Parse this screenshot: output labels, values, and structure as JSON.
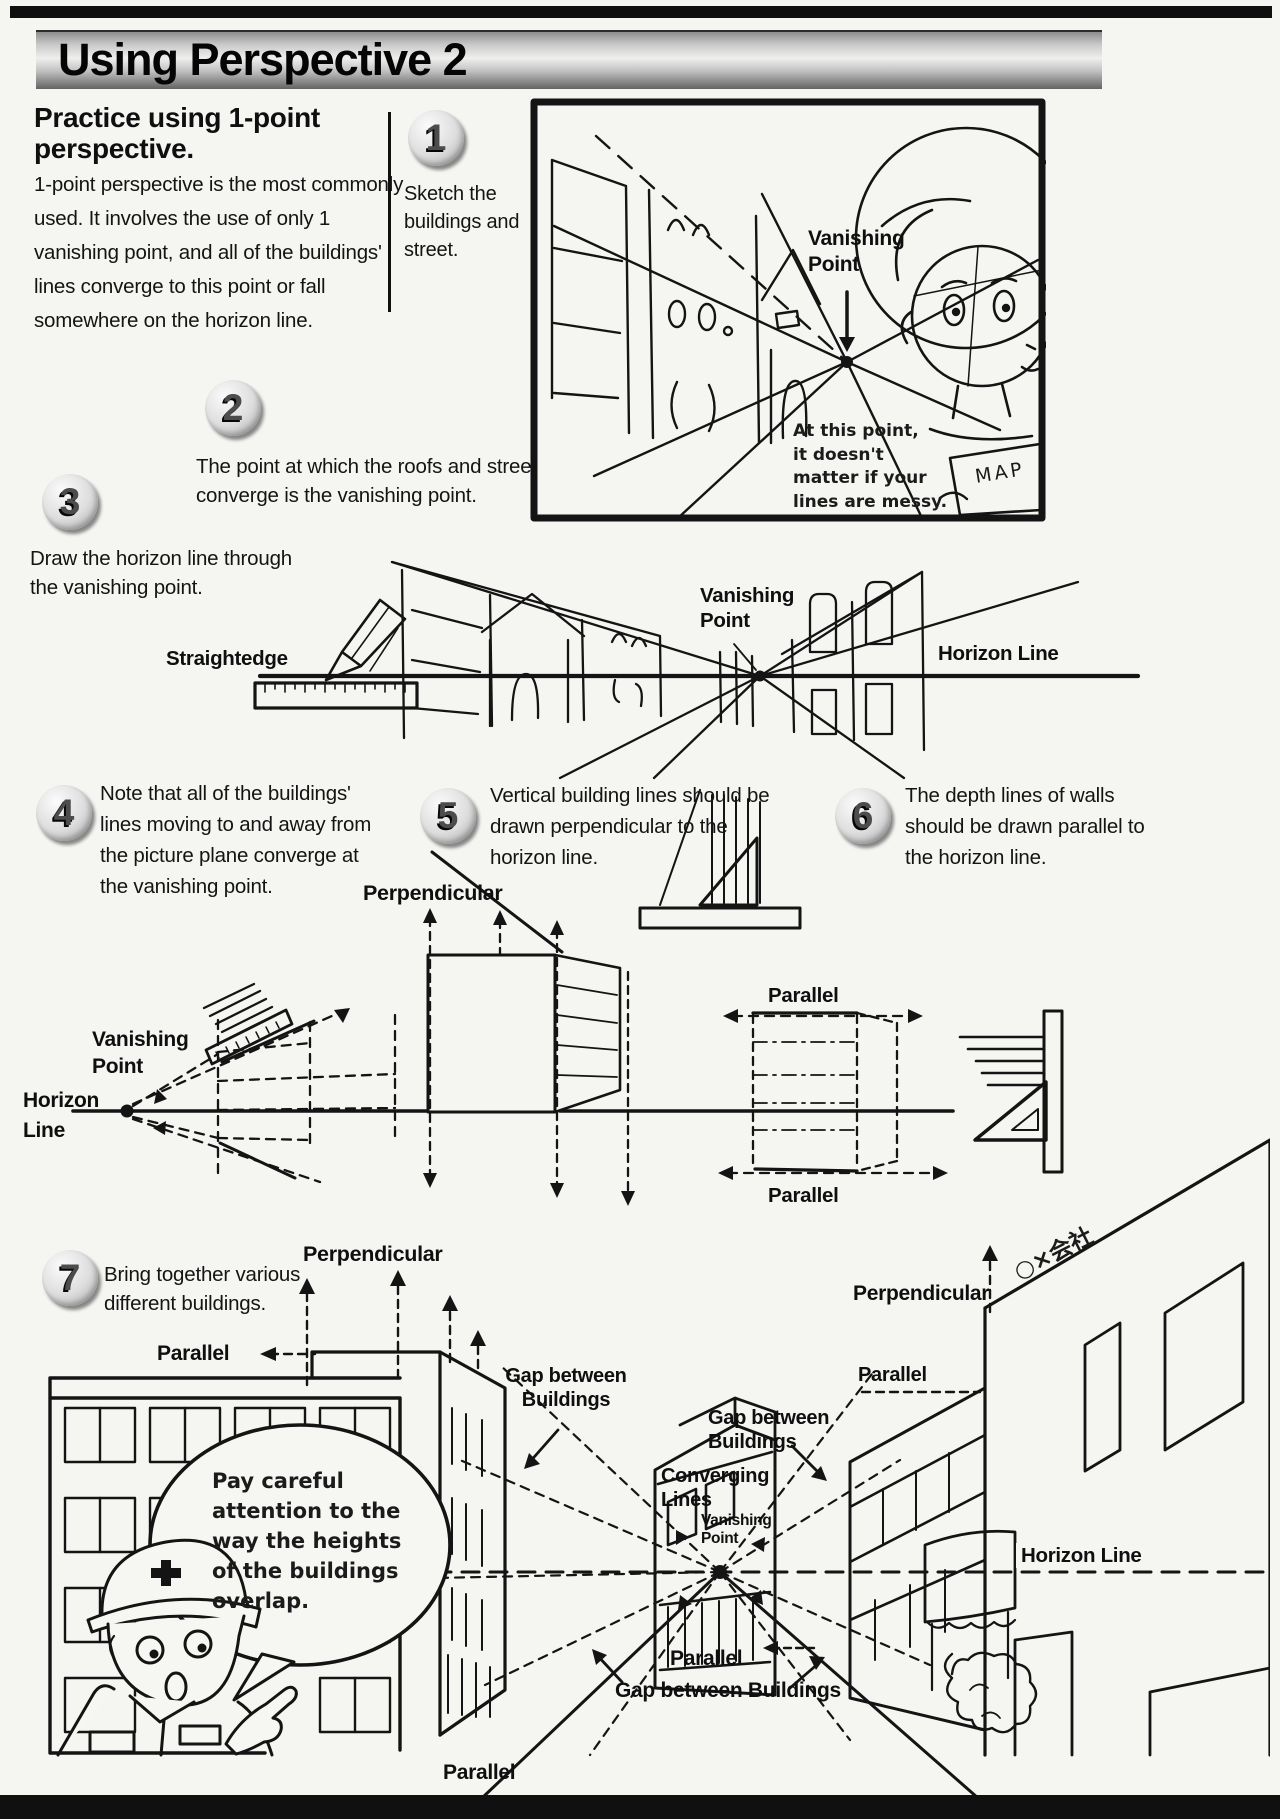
{
  "page": {
    "title": "Using Perspective 2"
  },
  "intro": {
    "heading": "Practice using 1-point\nperspective.",
    "body": "1-point perspective is the most commonly\nused. It involves the use of only 1\nvanishing point, and all of the buildings'\nlines converge to this point or fall\nsomewhere on the horizon line."
  },
  "steps": [
    {
      "num": "1",
      "text": "Sketch the\nbuildings and\nstreet."
    },
    {
      "num": "2",
      "text": "The point at which the roofs and street\nconverge is the vanishing point."
    },
    {
      "num": "3",
      "text": "Draw the horizon line through\nthe vanishing point."
    },
    {
      "num": "4",
      "text": "Note that all of the buildings'\nlines moving to and away from\nthe picture plane converge at\nthe vanishing point."
    },
    {
      "num": "5",
      "text": "Vertical building lines should be\ndrawn perpendicular to the\nhorizon line."
    },
    {
      "num": "6",
      "text": "The depth lines of walls\nshould be drawn parallel to\nthe horizon line."
    },
    {
      "num": "7",
      "text": "Bring together various\ndifferent buildings."
    }
  ],
  "panel1": {
    "vanishing_point": "Vanishing\nPoint",
    "note": "At this point,\nit doesn't\nmatter if your\nlines are messy.",
    "map": "MAP"
  },
  "diagram3": {
    "straightedge": "Straightedge",
    "vanishing_point": "Vanishing\nPoint",
    "horizon_line": "Horizon Line"
  },
  "diagram456": {
    "perpendicular": "Perpendicular",
    "vanishing_point": "Vanishing\nPoint",
    "horizon_line": "Horizon\nLine",
    "parallel_top": "Parallel",
    "parallel_bottom": "Parallel"
  },
  "scene7": {
    "perpendicular_left": "Perpendicular",
    "parallel_left": "Parallel",
    "gap_1": "Gap between\nBuildings",
    "gap_2": "Gap between\nBuildings",
    "converging_lines": "Converging\nLines",
    "vanishing_point": "Vanishing\nPoint",
    "horizon_line": "Horizon Line",
    "parallel_center": "Parallel",
    "gap_bottom": "Gap between Buildings",
    "parallel_bottom": "Parallel",
    "perpendicular_right": "Perpendicular",
    "parallel_right": "Parallel",
    "sign": "○×会社",
    "speech": "Pay careful\nattention to the\nway the heights\nof the buildings\noverlap."
  }
}
